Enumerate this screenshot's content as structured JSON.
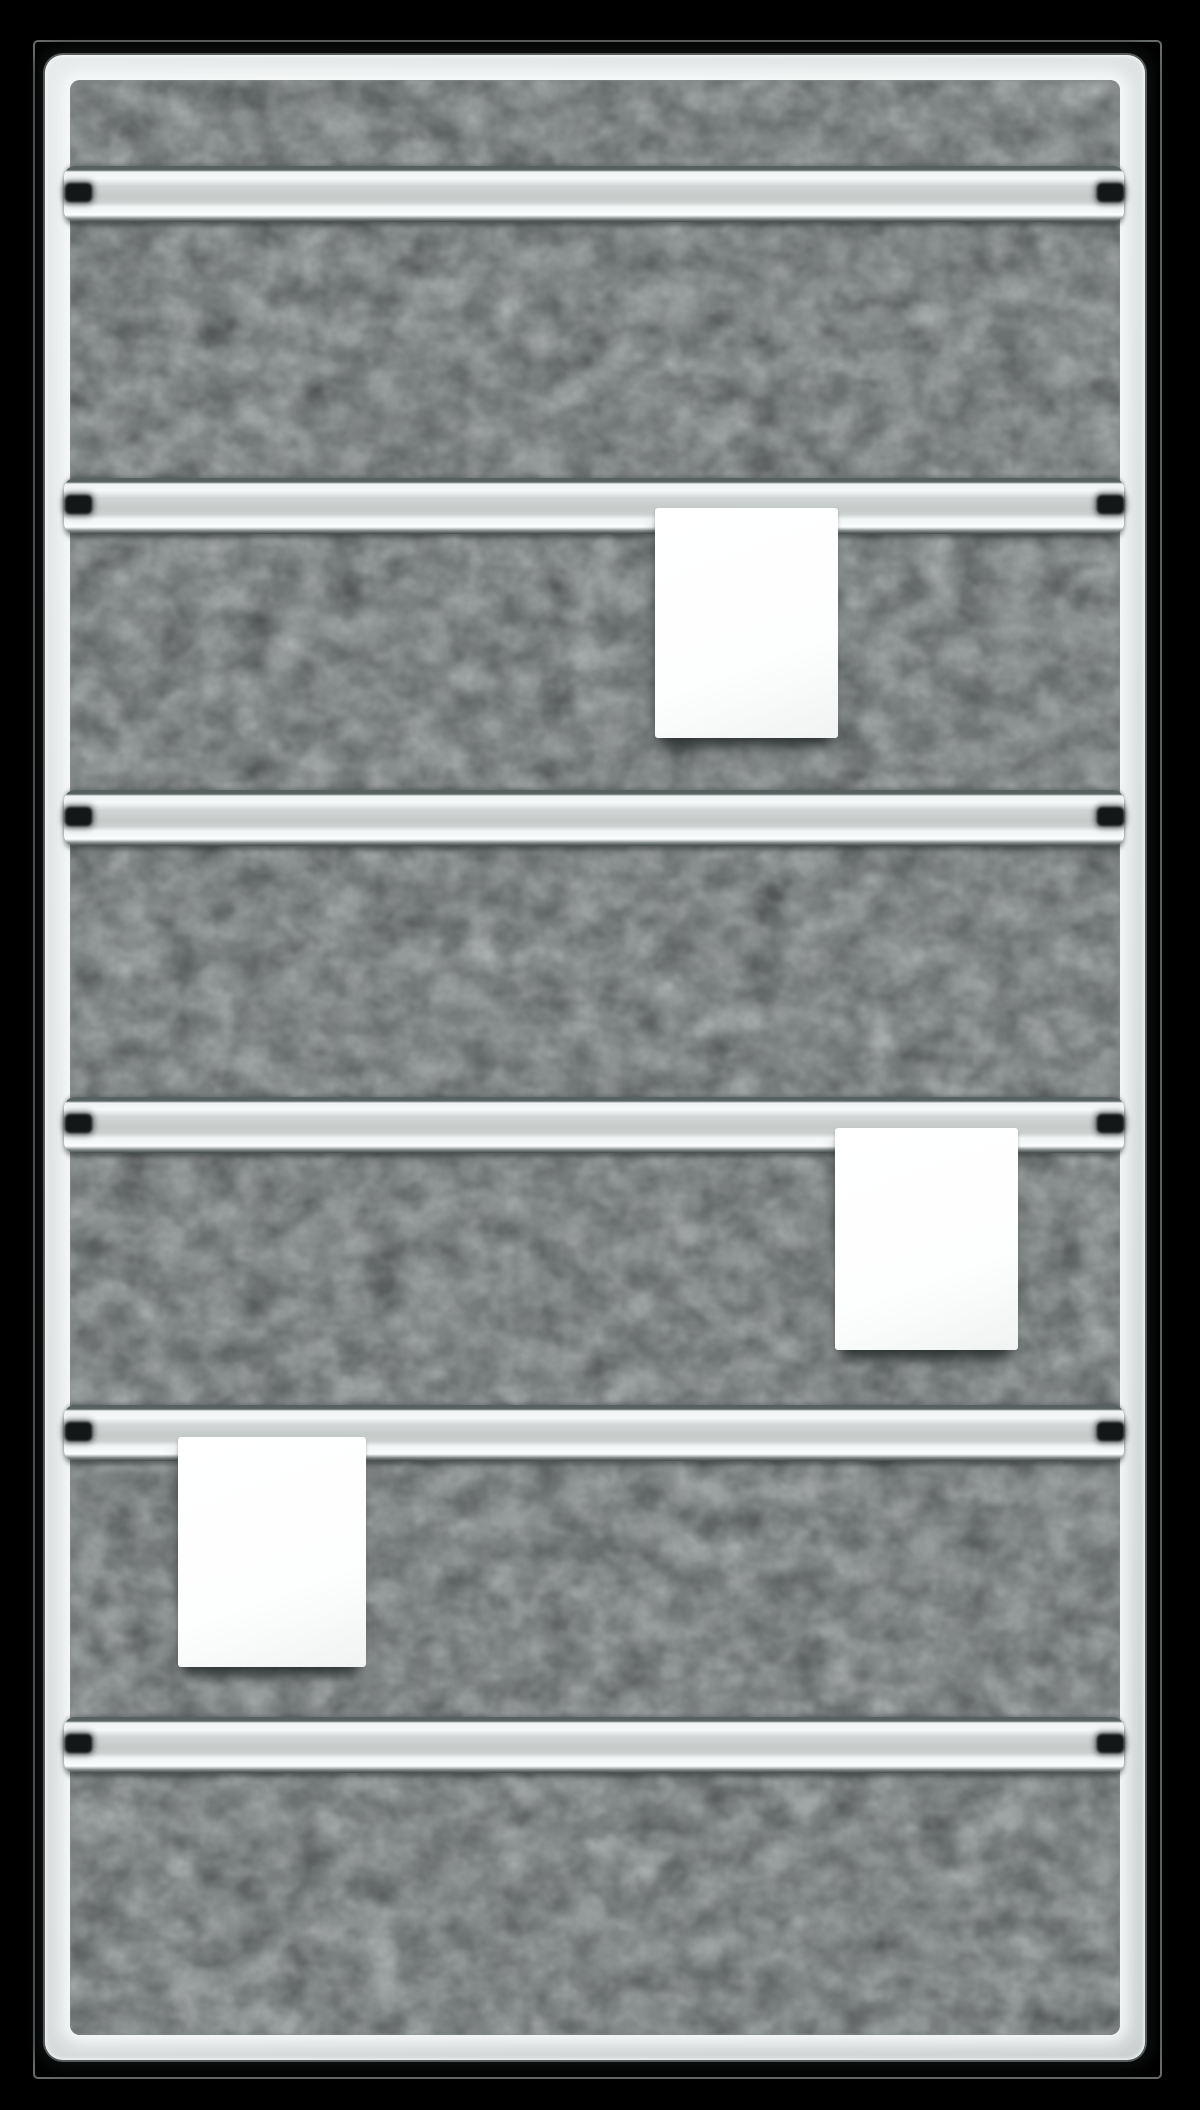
{
  "scene": {
    "description": "Photograph of a gray planning board with horizontal card rails and blank white cards, on a black background",
    "rail_count": 6,
    "card_count": 3,
    "colors": {
      "background": "#000000",
      "frame": "#dde1e1",
      "surface": "#8d9393",
      "rail_face": "#c6cbca",
      "rail_highlight": "#f7f9f9",
      "rail_shadow_line": "#565d5d",
      "end_clip": "#131717",
      "card": "#fdfdfd",
      "reflection_line": "#a0a6a6"
    }
  },
  "board": {
    "x": 45,
    "y": 55,
    "width": 1100,
    "height": 2005,
    "frame_thickness": 25,
    "rail_left": -6,
    "rail_width": 1060,
    "rail_height": 56
  },
  "rails": [
    {
      "id": 1,
      "top": 86
    },
    {
      "id": 2,
      "top": 398
    },
    {
      "id": 3,
      "top": 710
    },
    {
      "id": 4,
      "top": 1017
    },
    {
      "id": 5,
      "top": 1325
    },
    {
      "id": 6,
      "top": 1637
    }
  ],
  "cards": [
    {
      "id": 1,
      "rail": 2,
      "left": 585,
      "top": 428,
      "width": 183,
      "height": 230
    },
    {
      "id": 2,
      "rail": 4,
      "left": 765,
      "top": 1048,
      "width": 183,
      "height": 222
    },
    {
      "id": 3,
      "rail": 5,
      "left": 108,
      "top": 1357,
      "width": 188,
      "height": 230
    }
  ]
}
